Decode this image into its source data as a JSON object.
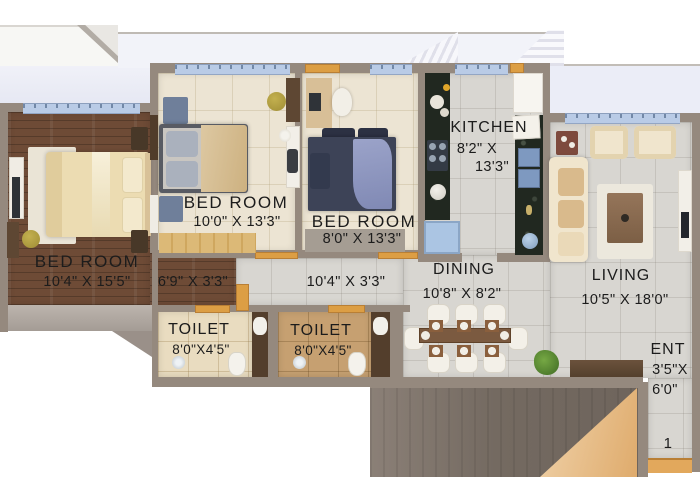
{
  "labels": {
    "bedroom_left": {
      "name": "BED ROOM",
      "dims": "10'4\" X 15'5\""
    },
    "bedroom_mid": {
      "name": "BED ROOM",
      "dims": "10'0\" X 13'3\""
    },
    "bedroom_right": {
      "name": "BED ROOM",
      "dims": "8'0\" X 13'3\""
    },
    "kitchen": {
      "name": "KITCHEN",
      "dims1": "8'2\" X",
      "dims2": "13'3\""
    },
    "dining": {
      "name": "DINING",
      "dims": "10'8\" X 8'2\""
    },
    "living": {
      "name": "LIVING",
      "dims": "10'5\" X 18'0\""
    },
    "toilet1": {
      "name": "TOILET",
      "dims": "8'0\"X4'5\""
    },
    "toilet2": {
      "name": "TOILET",
      "dims": "8'0\"X4'5\""
    },
    "entrance": {
      "name": "ENT",
      "dims1": "3'5\"X",
      "dims2": "6'0\""
    },
    "passage1": {
      "dims": "6'9\" X 3'3\""
    },
    "passage2": {
      "dims": "10'4\" X 3'3\""
    },
    "unit_number": "1"
  },
  "colors": {
    "wall": "#95897e",
    "wood_floor": "#6e4b36",
    "bedroom_tile": "#ece4d3",
    "living_tile": "#d8d6d1",
    "window_sill": "#b9cbe6",
    "door_accent": "#dc9e44",
    "kitchen_counter": "#212820",
    "label_text": "#1c1c1c"
  }
}
